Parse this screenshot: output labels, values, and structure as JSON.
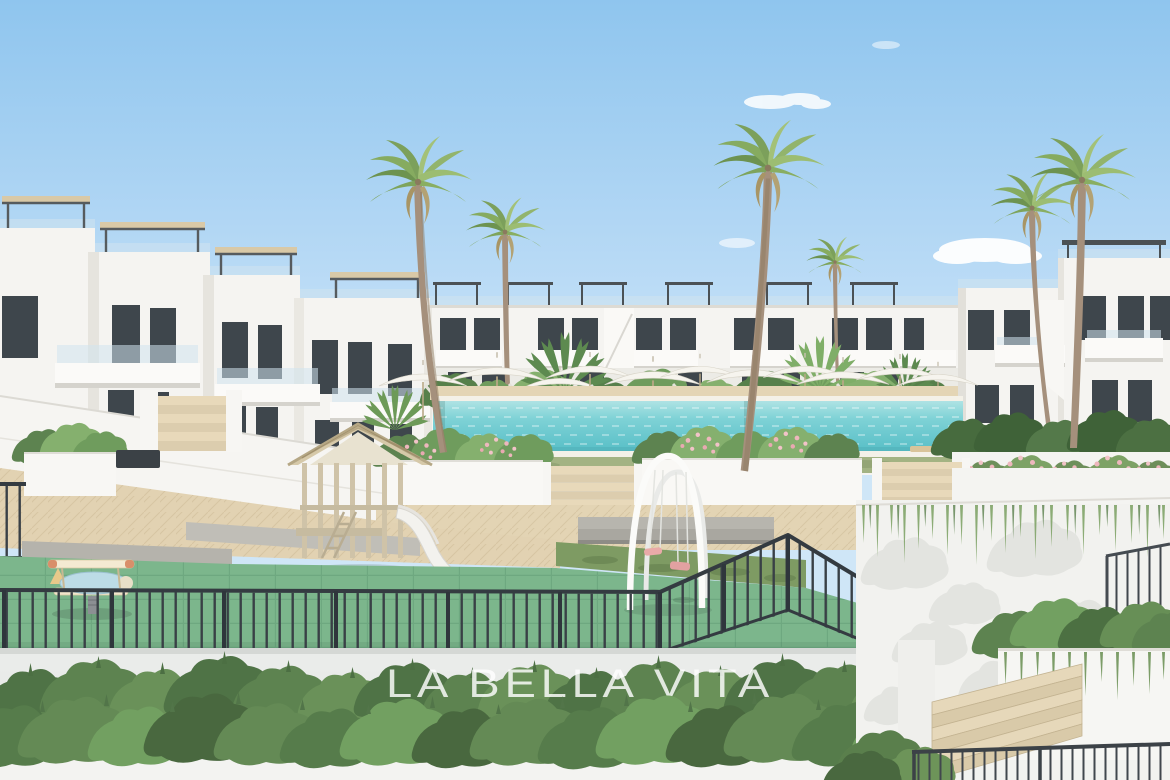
{
  "watermark": {
    "title": "LA BELLA VITA",
    "subtitle": "REAL ESTATE"
  },
  "scene": {
    "type": "3d-architectural-rendering",
    "description": "New-build white Mediterranean apartment complex around a communal courtyard: rooftop pergola terraces, tall fan palms, a long turquoise swimming pool lined with white parasols and sun loungers, tiered white planters with flowering shrubs, a fenced children's playground with wooden playhouse, white slide, swing set and airplane springer toy, fronted by a white wall with a clipped hedge.",
    "objects": [
      "sky",
      "clouds",
      "apartment buildings",
      "rooftop pergolas",
      "glass balustrades",
      "palm trees",
      "swimming pool",
      "parasols",
      "sun loungers",
      "planters",
      "garden steps",
      "lawn",
      "playground",
      "wooden playhouse",
      "white slide",
      "swing set",
      "airplane springer toy",
      "black metal fence",
      "hedge",
      "white perimeter wall",
      "terrace stairs",
      "railings"
    ]
  },
  "palette": {
    "sky": "#8fc5ee",
    "building_white": "#f5f4f1",
    "window_dark": "#3e464c",
    "pool_water": "#6fc9cf",
    "paving_beige": "#e2d2b2",
    "lawn_green": "#a3b383",
    "playground_green": "#7cb68c",
    "foliage_green": "#5d8350",
    "fence_dark": "#343b41",
    "wood_tan": "#d6c9a9",
    "swing_pink": "#e9aaa8",
    "watermark": "#ffffff"
  }
}
